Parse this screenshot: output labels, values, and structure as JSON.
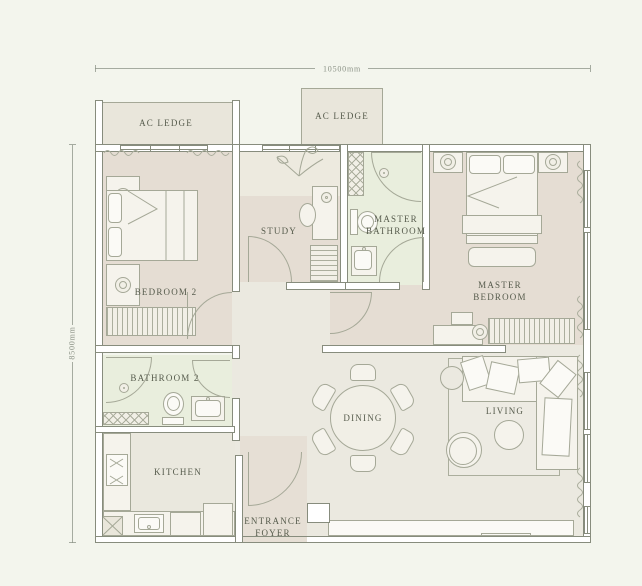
{
  "meta": {
    "type": "residential floor plan"
  },
  "dimensions": {
    "width_label": "10500mm",
    "height_label": "8500mm"
  },
  "rooms": {
    "ac_ledge_left": {
      "label": "AC LEDGE"
    },
    "ac_ledge_mid": {
      "label": "AC LEDGE"
    },
    "bedroom2": {
      "label": "BEDROOM 2"
    },
    "study": {
      "label": "STUDY"
    },
    "master_bathroom": {
      "line1": "MASTER",
      "line2": "BATHROOM"
    },
    "master_bedroom": {
      "line1": "MASTER",
      "line2": "BEDROOM"
    },
    "bathroom2": {
      "label": "BATHROOM 2"
    },
    "kitchen": {
      "label": "KITCHEN"
    },
    "dining": {
      "label": "DINING"
    },
    "living": {
      "label": "LIVING"
    },
    "entrance_foyer": {
      "line1": "ENTRANCE",
      "line2": "FOYER"
    }
  },
  "colors": {
    "bg": "#f3f5ed",
    "wall-fill": "#ffffff",
    "wall-line": "#878c7d",
    "furn-line": "#a5a897",
    "furn-fill": "#f1efe6",
    "furn-light": "#f5f3ec",
    "floor-bed": "#e5ddd3",
    "floor-study-top": "#edeadf",
    "floor-bath": "#e9eedd",
    "floor-living": "#ebe9e0",
    "floor-kitchen": "#eae8de",
    "floor-foyer": "#e6dfd5",
    "ledge": "#e9e6db",
    "label": "#565b4c",
    "dim": "#8b9286",
    "hatch": "#abae9d"
  }
}
